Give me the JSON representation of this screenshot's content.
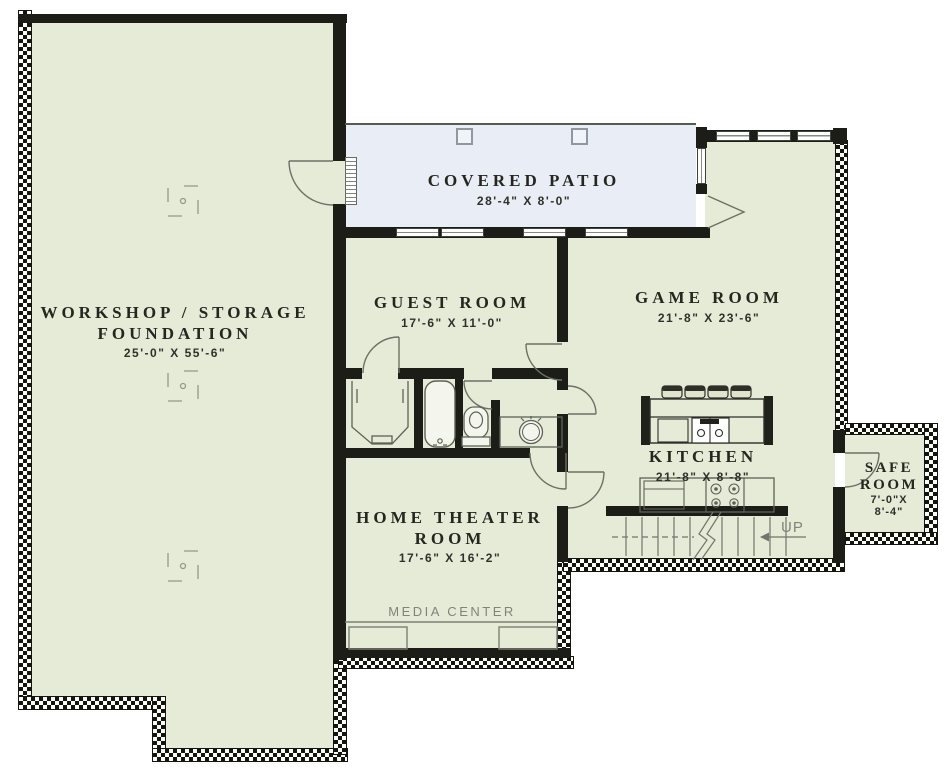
{
  "rooms": [
    {
      "id": "workshop",
      "name_line1": "WORKSHOP / STORAGE",
      "name_line2": "FOUNDATION",
      "dims": "25'-0\" X 55'-6\""
    },
    {
      "id": "covered-patio",
      "name_line1": "COVERED PATIO",
      "dims": "28'-4\" X 8'-0\""
    },
    {
      "id": "guest-room",
      "name_line1": "GUEST ROOM",
      "dims": "17'-6\" X 11'-0\""
    },
    {
      "id": "game-room",
      "name_line1": "GAME ROOM",
      "dims": "21'-8\" X 23'-6\""
    },
    {
      "id": "kitchen",
      "name_line1": "KITCHEN",
      "dims": "21'-8\" X 8'-8\""
    },
    {
      "id": "home-theater",
      "name_line1": "HOME THEATER",
      "name_line2": "ROOM",
      "dims": "17'-6\" X 16'-2\""
    },
    {
      "id": "safe-room",
      "name_line1": "SAFE",
      "name_line2": "ROOM",
      "dims_line1": "7'-0\"X",
      "dims_line2": "8'-4\""
    }
  ],
  "annotations": {
    "media_center": "MEDIA CENTER",
    "stairs_up": "UP"
  },
  "colors": {
    "room_fill": "#e6ebd8",
    "patio_fill": "#e8edf6",
    "wall": "#1d1d18",
    "foundation_hatch": "#15150f",
    "fixture_line": "#5d6256",
    "label_text": "#26261f",
    "gray_text": "#7f857a"
  }
}
